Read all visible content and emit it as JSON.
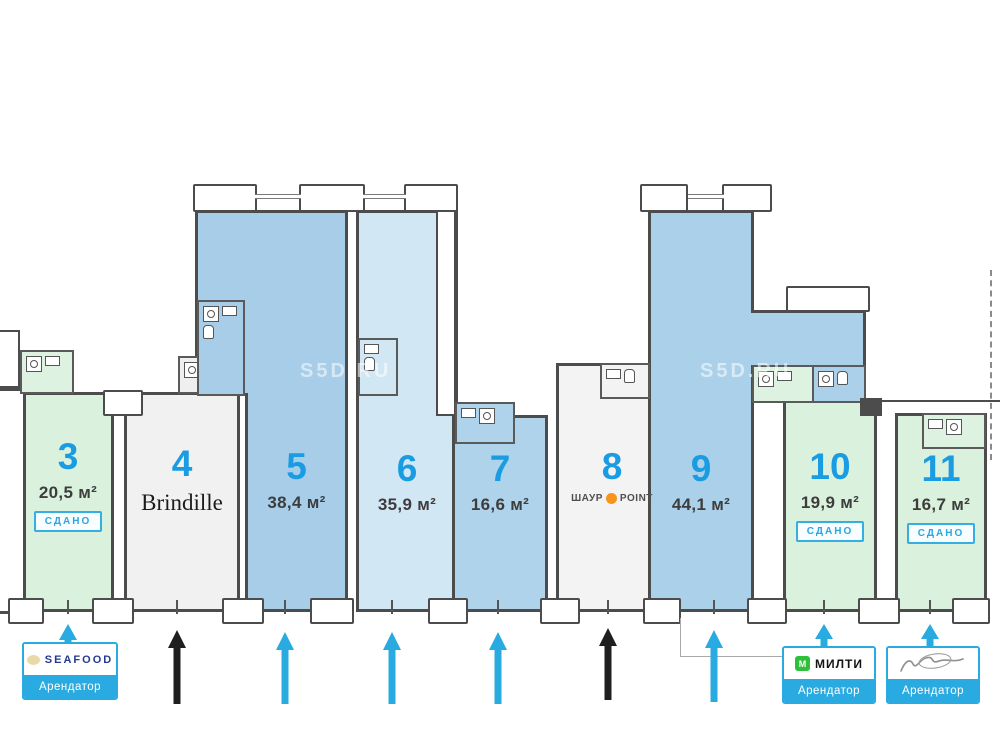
{
  "watermark": "S5D.RU",
  "units": [
    {
      "number": "3",
      "area": "20,5 м²",
      "status": "СДАНО"
    },
    {
      "number": "4",
      "tenant": "Brindille"
    },
    {
      "number": "5",
      "area": "38,4 м²"
    },
    {
      "number": "6",
      "area": "35,9 м²"
    },
    {
      "number": "7",
      "area": "16,6 м²"
    },
    {
      "number": "8",
      "logo_left": "ШАУР",
      "logo_right": "POINT"
    },
    {
      "number": "9",
      "area": "44,1 м²"
    },
    {
      "number": "10",
      "area": "19,9 м²",
      "status": "СДАНО"
    },
    {
      "number": "11",
      "area": "16,7 м²",
      "status": "СДАНО"
    }
  ],
  "tenant_badges": [
    {
      "logo": "SEAFOOD",
      "label": "Арендатор"
    },
    {
      "logo": "МИЛТИ",
      "label": "Арендатор"
    },
    {
      "logo": "подпись",
      "label": "Арендатор"
    }
  ],
  "colors": {
    "accent_blue": "#29abe2",
    "number_blue": "#1a9ce2",
    "arrow_black": "#1f1f1f",
    "milti_green": "#2ebf3b",
    "shaur_orange": "#f7941d"
  }
}
